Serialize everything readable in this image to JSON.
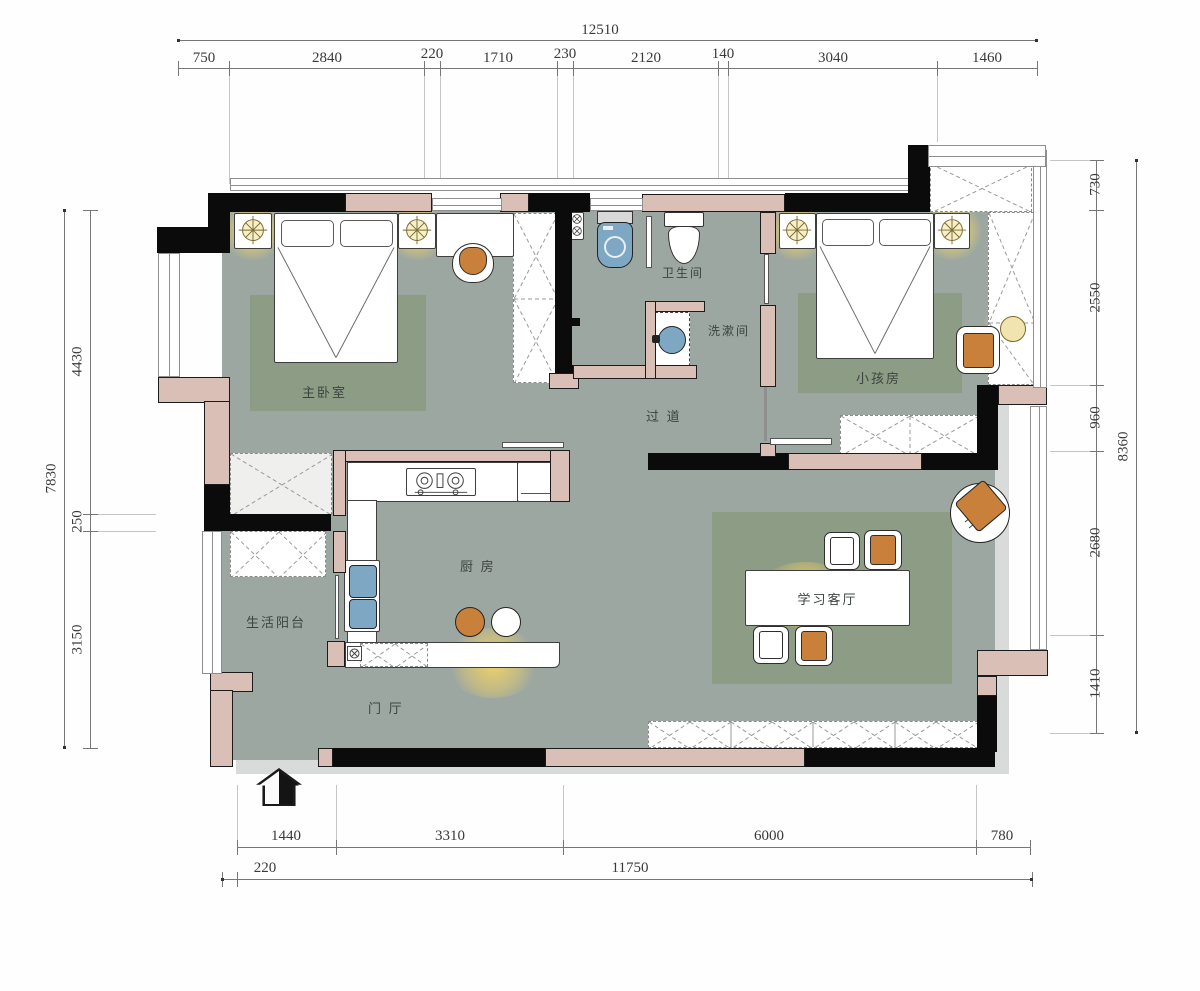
{
  "title": "apartment-floor-plan",
  "dims": {
    "top": {
      "total": "12510",
      "segs": [
        "750",
        "2840",
        "220",
        "1710",
        "230",
        "2120",
        "140",
        "3040",
        "1460"
      ]
    },
    "left": {
      "total": "7830",
      "segs": [
        "4430",
        "250",
        "3150"
      ]
    },
    "right": {
      "total": "8360",
      "segs": [
        "730",
        "2550",
        "960",
        "2680",
        "1410"
      ]
    },
    "bottom": {
      "segs": [
        "1440",
        "3310",
        "6000",
        "780"
      ],
      "segs2": [
        "220",
        "11750"
      ]
    }
  },
  "rooms": {
    "master": {
      "label": "主卧室"
    },
    "bath": {
      "label": "卫生间"
    },
    "wash": {
      "label": "洗漱间"
    },
    "kids": {
      "label": "小孩房"
    },
    "corridor": {
      "label": "过 道"
    },
    "kitchen": {
      "label": "厨 房"
    },
    "balcony": {
      "label": "生活阳台"
    },
    "entry": {
      "label": "门 厅"
    },
    "study": {
      "label": "学习客厅"
    }
  },
  "colors": {
    "floor": "#9CA7A1",
    "rug": "#8D9C85",
    "wall_structural": "#0B0B0B",
    "wall_infill": "#D9BFB6",
    "furniture_accent_orange": "#C9803B",
    "fixture_blue": "#7EA7C4",
    "lamp_glow": "#F3D464"
  }
}
